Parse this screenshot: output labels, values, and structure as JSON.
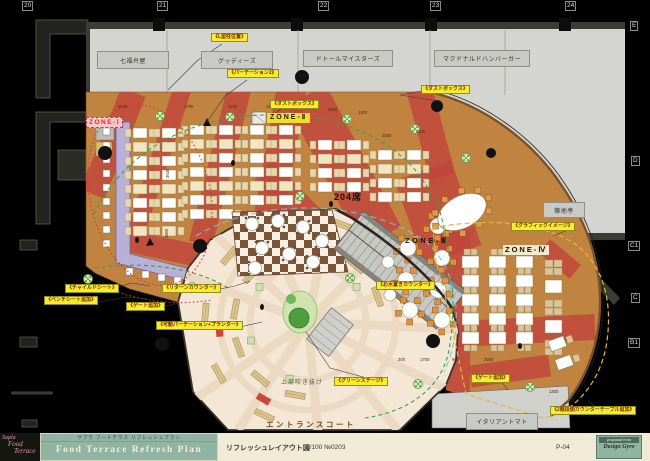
{
  "grid": {
    "columns": [
      "20",
      "21",
      "22",
      "23",
      "24"
    ],
    "rows": [
      "E",
      "D",
      "C1",
      "C",
      "B1"
    ]
  },
  "shops": [
    {
      "name": "七福弁屋"
    },
    {
      "name": "グッディーズ"
    },
    {
      "name": "ドトールマイスターズ"
    },
    {
      "name": "マクドナルドハンバーガー"
    },
    {
      "name": "築地亭"
    },
    {
      "name": "イタリアントマト"
    }
  ],
  "zones": [
    {
      "label": "ZONE-Ⅰ"
    },
    {
      "label": "ZONE-Ⅱ"
    },
    {
      "label": "ZONE-Ⅲ"
    },
    {
      "label": "ZONE-Ⅳ"
    }
  ],
  "annotations": {
    "l_pillar": "《L型柱位置》",
    "partition": "《パーテーション2》",
    "dustbox_1": "《ダストボックス》",
    "dustbox_2": "《ダストボックス》",
    "graphic_image": "《グラフィックイメージ》",
    "child_seat": "《チャイルドシート》",
    "bench_seat": "《ベンチシート追加》",
    "gate_left": "《ゲート追加》",
    "return_counter": "《リターンカウンター》",
    "water_counter": "《お水置きカウンター》",
    "movable_partition": "《可動パーテーション+プランター》",
    "green_stage": "《グリーンステージ》",
    "gate_right": "《ゲート追加》",
    "stair_counter": "《2階段側カウンターテーブル追加》"
  },
  "plan_texts": {
    "seats": "204席",
    "void_note": "上部吹き抜け",
    "entrance": "エントランスコート"
  },
  "dimensions": {
    "top": [
      "2045",
      "1700",
      "1100",
      "1100",
      "1100",
      "2600",
      "1100"
    ],
    "mid": [
      "2500",
      "1100"
    ],
    "bottom": [
      "200",
      "1700",
      "900",
      "2500"
    ],
    "right": [
      "1300"
    ],
    "vertical": [
      "3630",
      "1800"
    ]
  },
  "title_block": {
    "logo": {
      "line1": "Sapla",
      "line2": "Food",
      "line3": "Terrace"
    },
    "subtitle": "サプラ フードテラス リフレッシュプラン",
    "title": "Food Terrace Refresh Plan",
    "drawing_name": "リフレッシュレイアウト図",
    "scale": "1/100  №0203",
    "page": "P-04",
    "stamp": {
      "small": "proposal from",
      "name": "Design Gyro"
    }
  },
  "colors": {
    "floor_orange": "#c08440",
    "carpet_red": "#c1463c",
    "court_cream": "#f4e7d6",
    "label_yellow": "#f6ee2d",
    "zone1_pink": "#f6c6c9",
    "teal": "#8fb4a1"
  }
}
